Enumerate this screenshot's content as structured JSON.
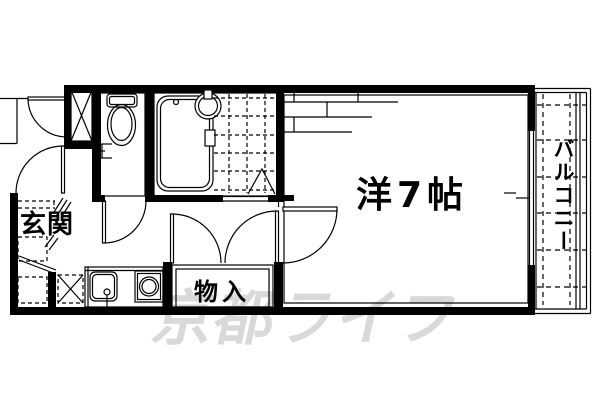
{
  "floorplan": {
    "labels": {
      "genkan": "玄関",
      "main_room": "洋7帖",
      "storage": "物入",
      "balcony": "バルコニー"
    },
    "watermark": "京都ライフ",
    "rooms": [
      {
        "name": "玄関",
        "type": "entrance"
      },
      {
        "name": "洋7帖",
        "type": "western-room",
        "size_tatami": 7
      },
      {
        "name": "物入",
        "type": "storage-closet"
      },
      {
        "name": "バルコニー",
        "type": "balcony"
      }
    ],
    "fixtures": [
      "toilet",
      "bathtub",
      "wash-basin",
      "kitchen-sink",
      "stove-burner",
      "shoe-cabinet",
      "washer-space",
      "tile-floor"
    ],
    "colors": {
      "line": "#000000",
      "background": "#ffffff",
      "watermark": "#d9d9d9"
    }
  }
}
